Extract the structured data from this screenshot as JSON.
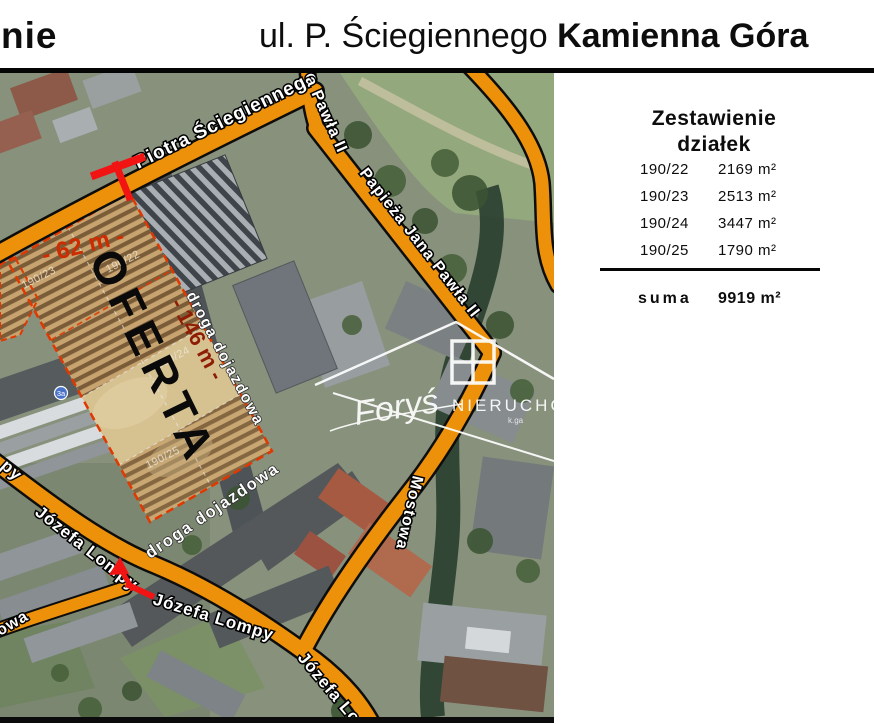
{
  "header": {
    "left_fragment": "nie",
    "title_regular": "ul. P. Ściegiennego",
    "title_bold": "Kamienna Góra"
  },
  "panel": {
    "title_line1": "Zestawienie",
    "title_line2": "działek",
    "rows": [
      {
        "plot": "190/22",
        "area": "2169 m²"
      },
      {
        "plot": "190/23",
        "area": "2513 m²"
      },
      {
        "plot": "190/24",
        "area": "3447 m²"
      },
      {
        "plot": "190/25",
        "area": "1790 m²"
      }
    ],
    "suma_label": "suma",
    "suma_value": "9919 m²"
  },
  "map": {
    "offer": "OFERTA",
    "measure_width": "- 62 m -",
    "measure_length": "- 146 m -",
    "plot_ids": {
      "p22": "190/22",
      "p23": "190/23",
      "p24": "190/24",
      "p25": "190/25"
    },
    "streets": {
      "sciegiennego": "Piotra Ściegiennego",
      "pawla_fragment": "a Pawła II",
      "papieza": "Papieża Jana Pawła II",
      "mostowa": "Mostowa",
      "lompy_a": "Józefa Lompy",
      "lompy_b": "Józefa Lompy",
      "lompy_c": "Józefa Lom",
      "fragment_py": "py",
      "fragment_owa": "owa",
      "droga_a": "droga dojazdowa",
      "droga_b": "droga dojazdowa"
    },
    "marker_3a": "3a",
    "watermark": {
      "script": "Foryś",
      "caps": "NIERUCHO",
      "small": "k.ga"
    }
  },
  "colors": {
    "road_orange": "#EC9109",
    "plot_outline": "#E03800",
    "marker_red": "#F21313",
    "measure_red": "#CE2B00",
    "measure_dark_red": "#8F1D05",
    "access_road_gray": "#4E5357",
    "river_green": "#2D4233"
  }
}
